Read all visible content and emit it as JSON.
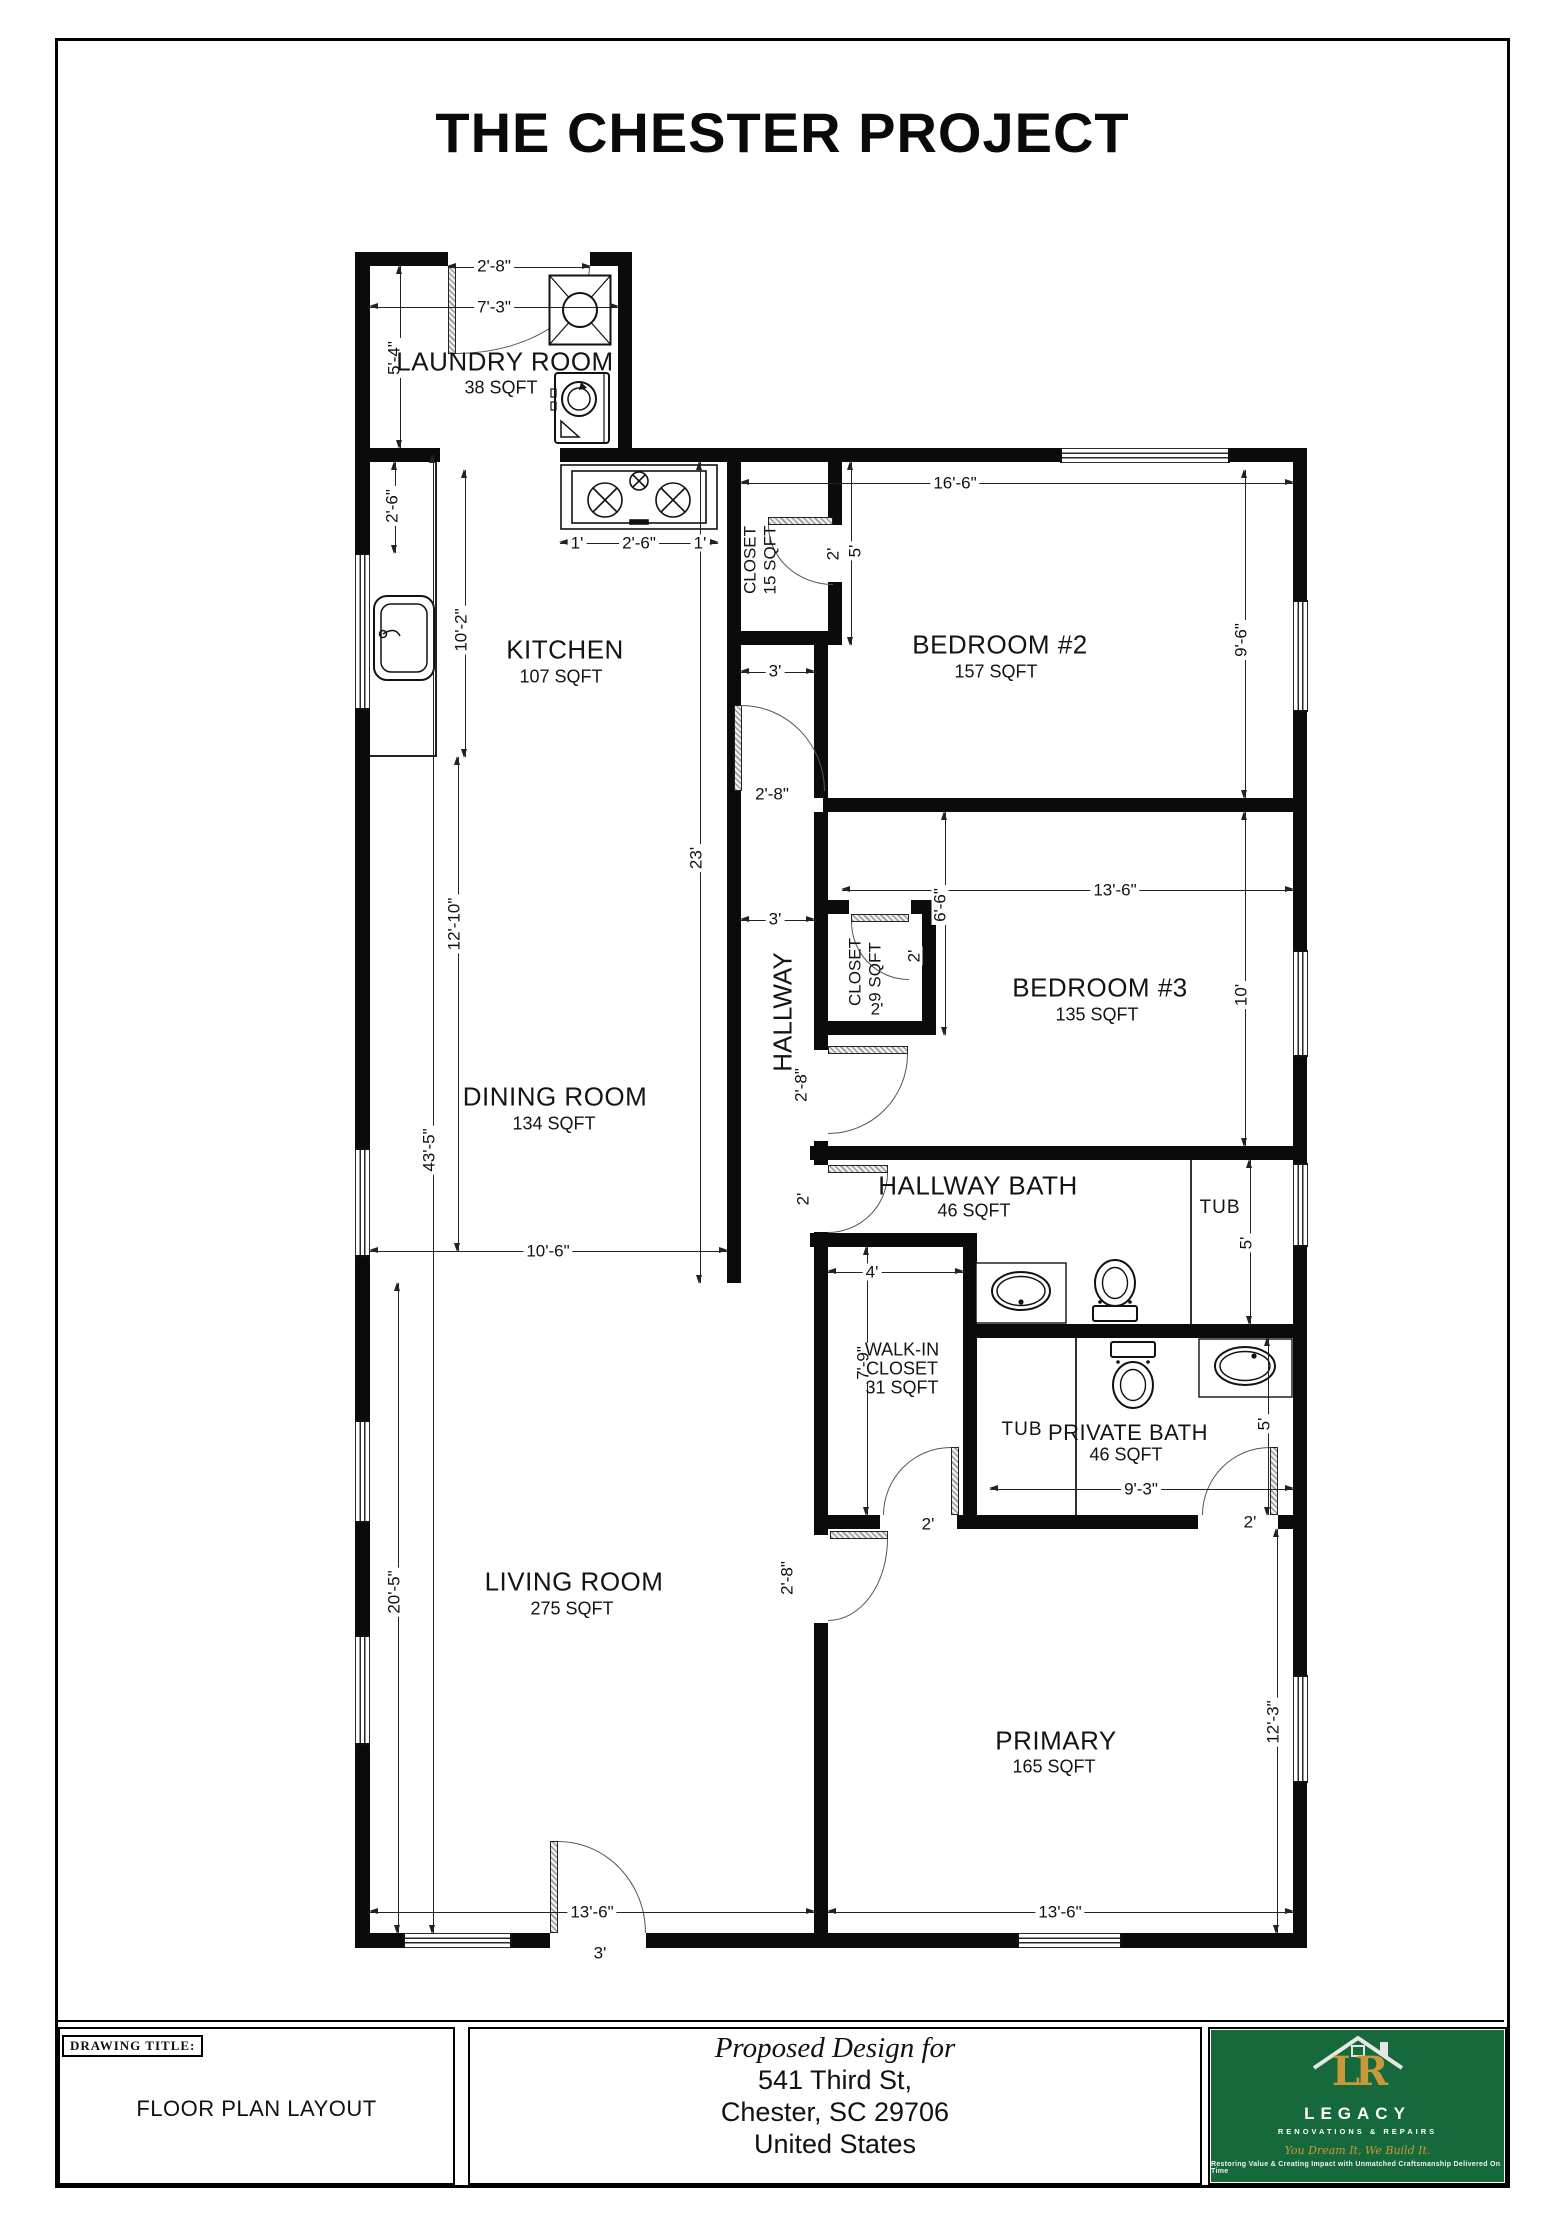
{
  "page": {
    "title": "THE CHESTER PROJECT"
  },
  "rooms": {
    "laundry": {
      "name": "LAUNDRY ROOM",
      "size": "38 SQFT"
    },
    "kitchen": {
      "name": "KITCHEN",
      "size": "107 SQFT"
    },
    "dining": {
      "name": "DINING ROOM",
      "size": "134 SQFT"
    },
    "living": {
      "name": "LIVING ROOM",
      "size": "275 SQFT"
    },
    "bedroom2": {
      "name": "BEDROOM #2",
      "size": "157 SQFT"
    },
    "bedroom3": {
      "name": "BEDROOM #3",
      "size": "135 SQFT"
    },
    "primary": {
      "name": "PRIMARY",
      "size": "165 SQFT"
    },
    "hallway": {
      "name": "HALLWAY"
    },
    "hallway_bath": {
      "name": "HALLWAY BATH",
      "size": "46 SQFT"
    },
    "private_bath": {
      "name": "PRIVATE BATH",
      "size": "46 SQFT"
    },
    "walkin": {
      "line1": "WALK-IN",
      "line2": "CLOSET",
      "line3": "31 SQFT"
    },
    "closet_bed2": {
      "name": "CLOSET",
      "size": "15 SQFT"
    },
    "closet_bed3": {
      "name": "CLOSET",
      "size": "9 SQFT"
    },
    "tub_hallway": "TUB",
    "tub_private": "TUB"
  },
  "dims": {
    "laundry_door": "2'-8\"",
    "laundry_width": "7'-3\"",
    "laundry_height": "5'-4\"",
    "kitchen_left_seg": "2'-6\"",
    "counter_length": "10'-2\"",
    "stove_left": "1'",
    "stove_width": "2'-6\"",
    "stove_right": "1'",
    "kitchen_dining_height": "23'",
    "closet2_door": "2'",
    "closet2_depth": "5'",
    "bedroom2_width": "16'-6\"",
    "bedroom2_height": "9'-6\"",
    "hallway_top_width": "3'",
    "bedroom2_door": "2'-8\"",
    "hallway_mid_width": "3'",
    "bedroom3_width": "13'-6\"",
    "bedroom3_height": "10'",
    "bedroom3_door": "2'-8\"",
    "closet3_depth": "6'-6\"",
    "closet3_door_v": "2'",
    "closet3_width": "2'",
    "hallbath_door": "2'",
    "tub1_length": "5'",
    "walkin_width": "4'",
    "walkin_depth": "7'-9\"",
    "privatebath_height": "5'",
    "privatebath_width": "9'-3\"",
    "walkin_door": "2'",
    "privatebath_door": "2'",
    "primary_door": "2'-8\"",
    "living_height": "20'-5\"",
    "primary_height": "12'-3\"",
    "living_width": "13'-6\"",
    "primary_width": "13'-6\"",
    "front_door": "3'",
    "dining_height": "12'-10\"",
    "total_height": "43'-5\"",
    "dining_width": "10'-6\""
  },
  "title_block": {
    "drawing_title_label": "DRAWING TITLE:",
    "drawing_title": "FLOOR PLAN LAYOUT",
    "proposed": "Proposed Design for",
    "address_line1": "541 Third St,",
    "address_line2": "Chester, SC 29706",
    "address_line3": "United States",
    "logo": {
      "monogram": "LR",
      "name": "LEGACY",
      "subtitle": "RENOVATIONS & REPAIRS",
      "tagline": "You Dream It, We Build It.",
      "motto": "Restoring Value & Creating Impact with Unmatched Craftsmanship Delivered On Time",
      "green": "#16693a",
      "gold": "#c8993c"
    }
  }
}
